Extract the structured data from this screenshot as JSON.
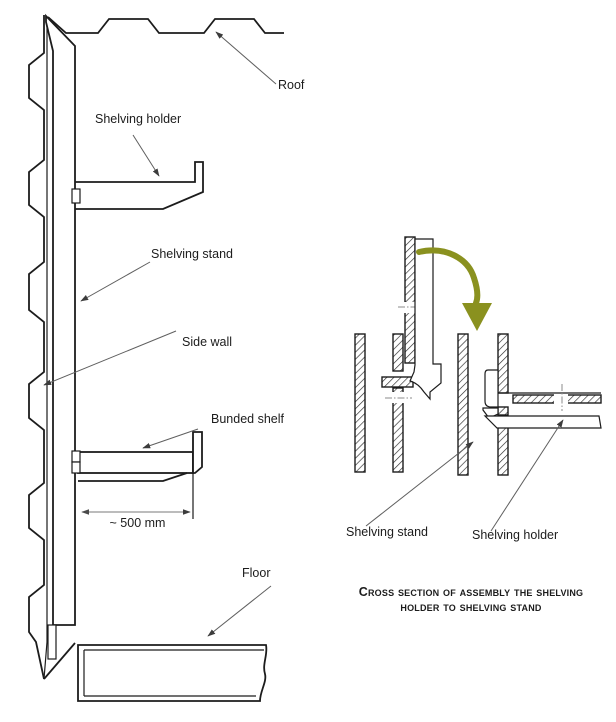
{
  "diagram": {
    "labels": {
      "roof": "Roof",
      "shelving_holder": "Shelving holder",
      "shelving_stand": "Shelving stand",
      "side_wall": "Side wall",
      "bunded_shelf": "Bunded shelf",
      "floor": "Floor",
      "cs_shelving_stand": "Shelving stand",
      "cs_shelving_holder": "Shelving holder"
    },
    "dimension": {
      "shelf_depth": "~ 500 mm"
    },
    "caption": {
      "line1": "Cross section of assembly the shelving",
      "line2": "holder to shelving stand"
    },
    "colors": {
      "line": "#1c1c1c",
      "leader": "#5f5f5f",
      "assembly_arrow": "#8a911f",
      "background": "#ffffff"
    }
  }
}
